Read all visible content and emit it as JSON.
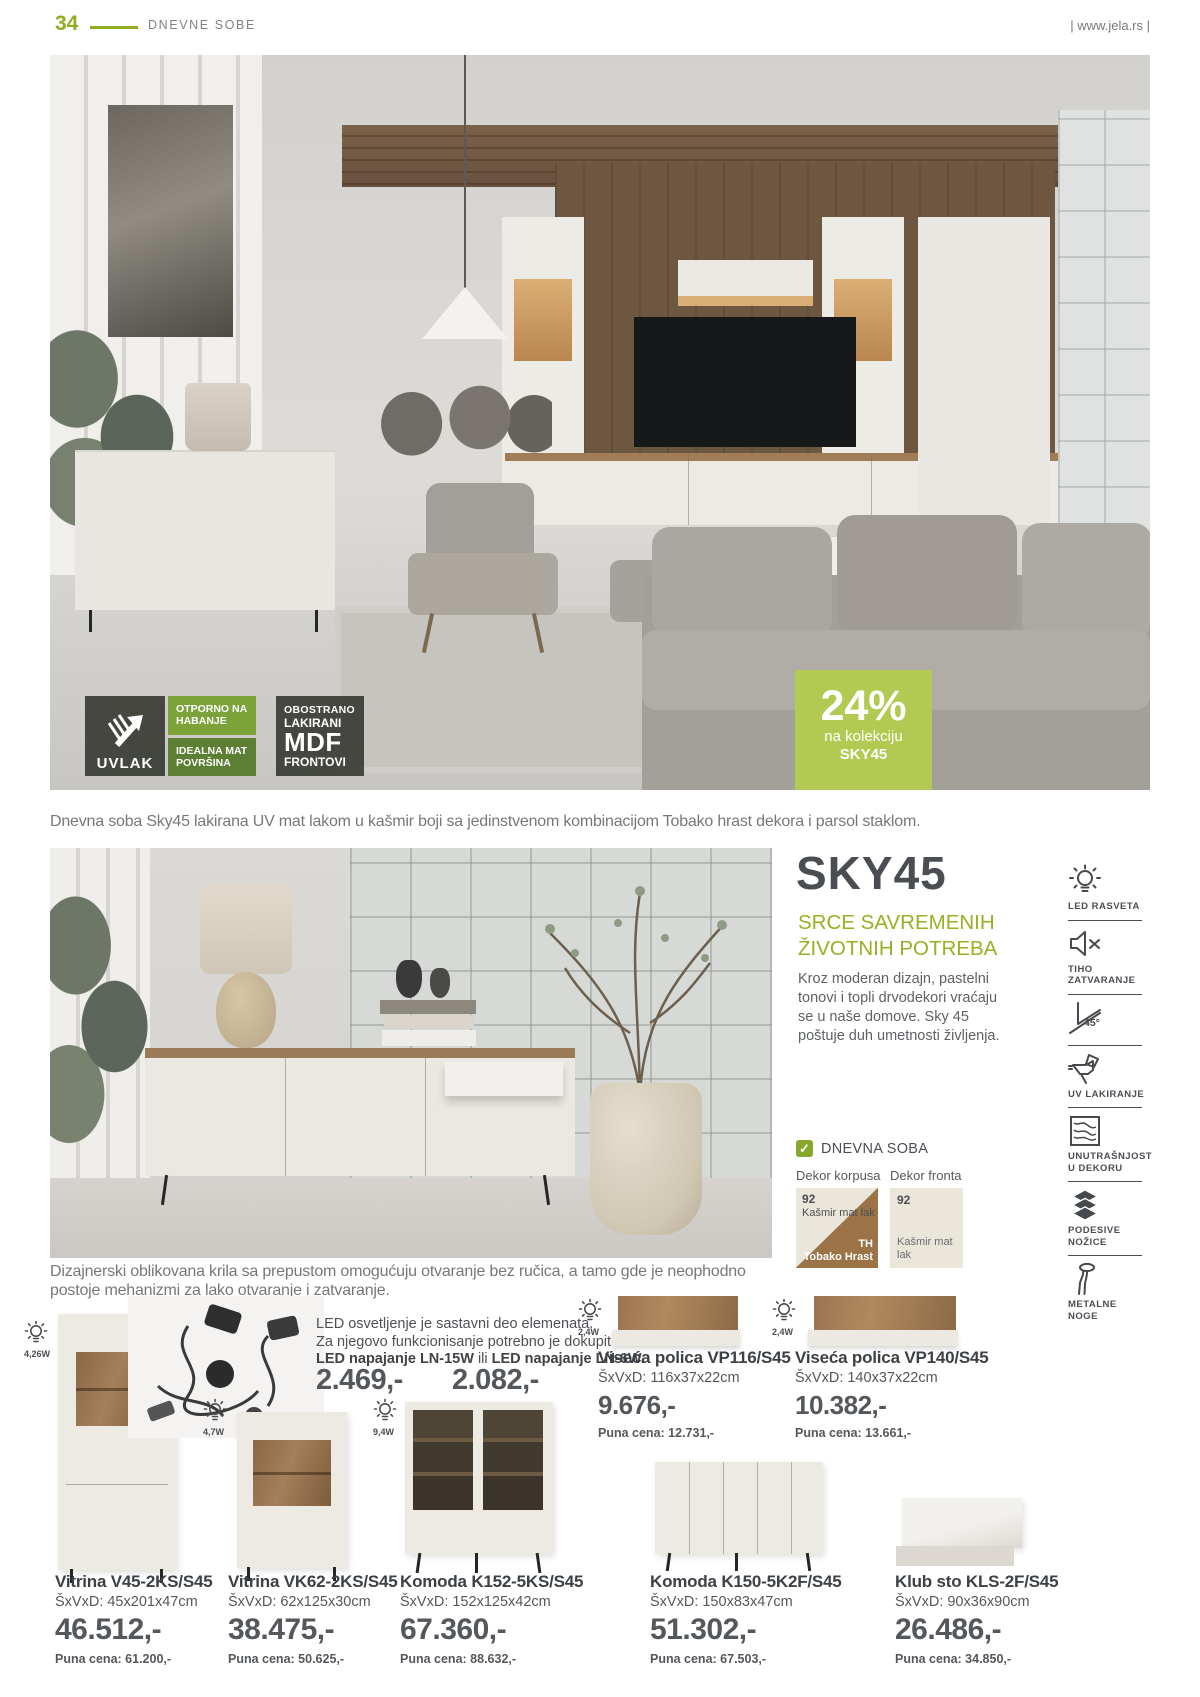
{
  "header": {
    "page_number": "34",
    "section": "DNEVNE SOBE",
    "website": "| www.jela.rs |"
  },
  "hero": {
    "uvlak_label": "UVLAK",
    "cell1": "OTPORNO NA HABANJE",
    "cell2": "IDEALNA MAT POVRŠINA",
    "mdf_line1": "OBOSTRANO",
    "mdf_line2": "LAKIRANI",
    "mdf_line3": "MDF",
    "mdf_line4": "FRONTOVI",
    "discount_percent": "24%",
    "discount_line1": "na kolekciju",
    "discount_line2": "SKY45",
    "caption": "Dnevna soba Sky45 lakirana UV mat lakom u kašmir boji sa jedinstvenom kombinacijom Tobako hrast dekora i parsol staklom."
  },
  "collection": {
    "title": "SKY45",
    "subtitle1": "SRCE SAVREMENIH",
    "subtitle2": "ŽIVOTNIH POTREBA",
    "description": "Kroz moderan dizajn, pastelni tonovi i topli drvodekori vraćaju se u naše domove. Sky 45 poštuje duh umetnosti življenja.",
    "room_tag": "DNEVNA SOBA",
    "check": "✓",
    "dekor_korpusa_label": "Dekor korpusa",
    "dekor_fronta_label": "Dekor fronta",
    "korpus_code1": "92",
    "korpus_name1": "Kašmir mat lak",
    "korpus_code2": "TH",
    "korpus_name2": "Tobako Hrast",
    "front_code": "92",
    "front_name": "Kašmir mat lak",
    "caption": "Dizajnerski oblikovana krila sa prepustom omogućuju otvaranje bez ručica, a tamo gde je neophodno postoje mehanizmi za lako otvaranje i zatvaranje."
  },
  "features": [
    {
      "label": "LED RASVETA"
    },
    {
      "label": "TIHO ZATVARANJE"
    },
    {
      "label": "SPOJ",
      "badge": "45°"
    },
    {
      "label": "UV LAKIRANJE"
    },
    {
      "label": "UNUTRAŠNJOST U DEKORU"
    },
    {
      "label": "PODESIVE NOŽICE"
    },
    {
      "label": "METALNE NOGE"
    }
  ],
  "led_info": {
    "line1": "LED osvetljenje je sastavni deo elemenata.",
    "line2": "Za njegovo funkcionisanje potrebno je dokupiti",
    "bold1": "LED napajanje LN-15W",
    "mid": " ili ",
    "bold2": "LED napajanje LN-6W.",
    "price1": "2.469,-",
    "price2": "2.082,-"
  },
  "products": [
    {
      "watt": "2,4W",
      "name": "Viseća polica VP116/S45",
      "dims": "ŠxVxD: 116x37x22cm",
      "price": "9.676,-",
      "full_price": "Puna cena: 12.731,-"
    },
    {
      "watt": "2,4W",
      "name": "Viseća polica VP140/S45",
      "dims": "ŠxVxD: 140x37x22cm",
      "price": "10.382,-",
      "full_price": "Puna cena: 13.661,-"
    },
    {
      "watt": "4,26W",
      "name": "Vitrina V45-2KS/S45",
      "dims": "ŠxVxD: 45x201x47cm",
      "price": "46.512,-",
      "full_price": "Puna cena: 61.200,-"
    },
    {
      "watt": "4,7W",
      "name": "Vitrina VK62-2KS/S45",
      "dims": "ŠxVxD: 62x125x30cm",
      "price": "38.475,-",
      "full_price": "Puna cena: 50.625,-"
    },
    {
      "watt": "9,4W",
      "name": "Komoda K152-5KS/S45",
      "dims": "ŠxVxD: 152x125x42cm",
      "price": "67.360,-",
      "full_price": "Puna cena: 88.632,-"
    },
    {
      "name": "Komoda K150-5K2F/S45",
      "dims": "ŠxVxD: 150x83x47cm",
      "price": "51.302,-",
      "full_price": "Puna cena: 67.503,-"
    },
    {
      "name": "Klub sto KLS-2F/S45",
      "dims": "ŠxVxD: 90x36x90cm",
      "price": "26.486,-",
      "full_price": "Puna cena: 34.850,-"
    }
  ],
  "colors": {
    "accent_green": "#8fad1f",
    "badge_green": "#b2c952",
    "cell_green_light": "#7ca23a",
    "cell_green_dark": "#5c7f33",
    "dark_badge": "#3a3c36",
    "text_dark": "#4a4e53",
    "text_gray": "#75787b"
  }
}
